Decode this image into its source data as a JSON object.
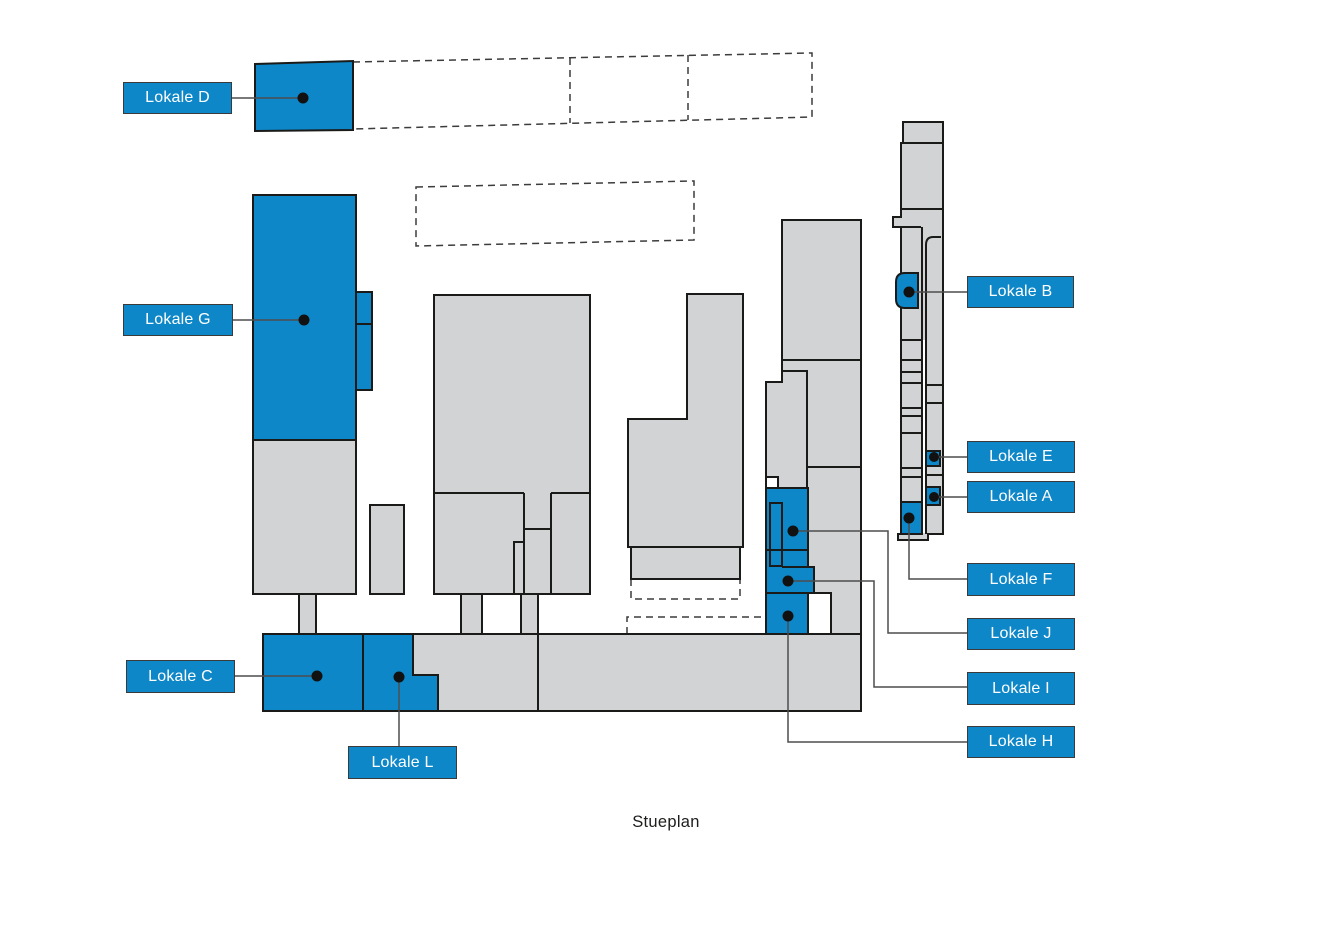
{
  "plan": {
    "caption": "Stueplan",
    "rooms": [
      {
        "id": "lokale-d",
        "label": "Lokale D"
      },
      {
        "id": "lokale-g",
        "label": "Lokale G"
      },
      {
        "id": "lokale-c",
        "label": "Lokale C"
      },
      {
        "id": "lokale-l",
        "label": "Lokale L"
      },
      {
        "id": "lokale-b",
        "label": "Lokale B"
      },
      {
        "id": "lokale-e",
        "label": "Lokale E"
      },
      {
        "id": "lokale-a",
        "label": "Lokale A"
      },
      {
        "id": "lokale-f",
        "label": "Lokale F"
      },
      {
        "id": "lokale-j",
        "label": "Lokale J"
      },
      {
        "id": "lokale-i",
        "label": "Lokale I"
      },
      {
        "id": "lokale-h",
        "label": "Lokale H"
      }
    ],
    "colors": {
      "highlight": "#0E87C8",
      "building": "#D2D3D5",
      "outline": "#1A1A18",
      "leader": "#4D4D4D",
      "label_text": "#FFFFFF",
      "caption_text": "#1D1D1B",
      "background": "#FFFFFF"
    }
  }
}
